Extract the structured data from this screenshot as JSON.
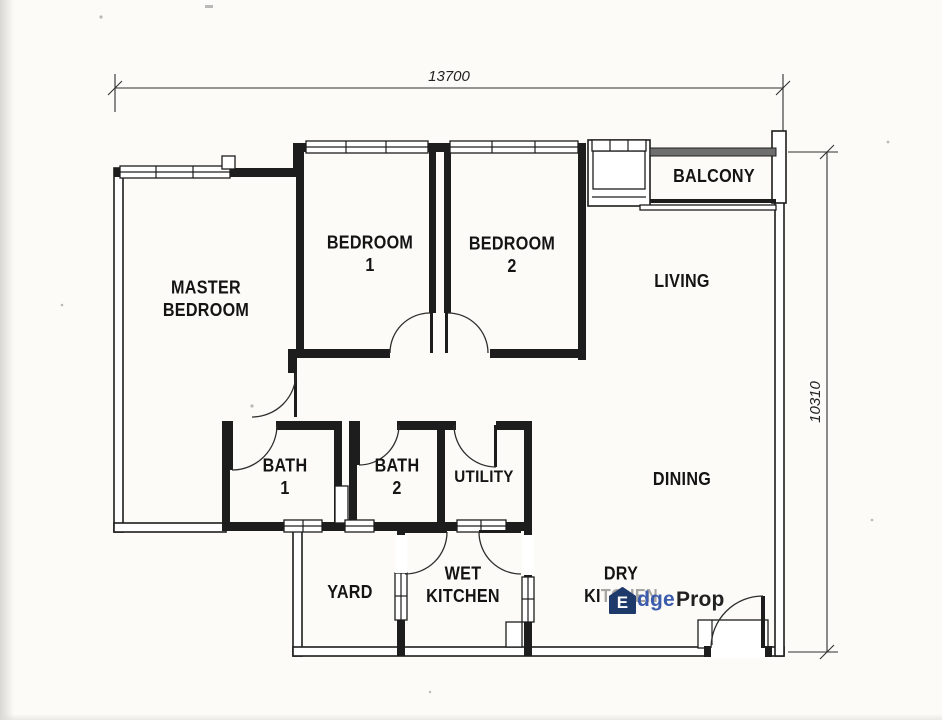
{
  "plan": {
    "dimensions": {
      "width": "13700",
      "height": "10310"
    },
    "rooms": [
      {
        "name": "master-bedroom",
        "lines": [
          "MASTER",
          "BEDROOM"
        ]
      },
      {
        "name": "bedroom-1",
        "lines": [
          "BEDROOM",
          "1"
        ]
      },
      {
        "name": "bedroom-2",
        "lines": [
          "BEDROOM",
          "2"
        ]
      },
      {
        "name": "balcony",
        "lines": [
          "BALCONY"
        ]
      },
      {
        "name": "living",
        "lines": [
          "LIVING"
        ]
      },
      {
        "name": "bath-1",
        "lines": [
          "BATH",
          "1"
        ]
      },
      {
        "name": "bath-2",
        "lines": [
          "BATH",
          "2"
        ]
      },
      {
        "name": "utility",
        "lines": [
          "UTILITY"
        ]
      },
      {
        "name": "dining",
        "lines": [
          "DINING"
        ]
      },
      {
        "name": "yard",
        "lines": [
          "YARD"
        ]
      },
      {
        "name": "wet-kitchen",
        "lines": [
          "WET",
          "KITCHEN"
        ]
      },
      {
        "name": "dry-kitchen",
        "line1": "DRY",
        "line2_black": "KI",
        "line2_ghost": "TCHEN"
      }
    ]
  },
  "watermark": {
    "icon_letter": "E",
    "text_blue": "dge",
    "text_dark": "Prop",
    "colors": {
      "house": "#1e3a6b",
      "blue": "#3b5bad",
      "dark": "#212121"
    }
  }
}
